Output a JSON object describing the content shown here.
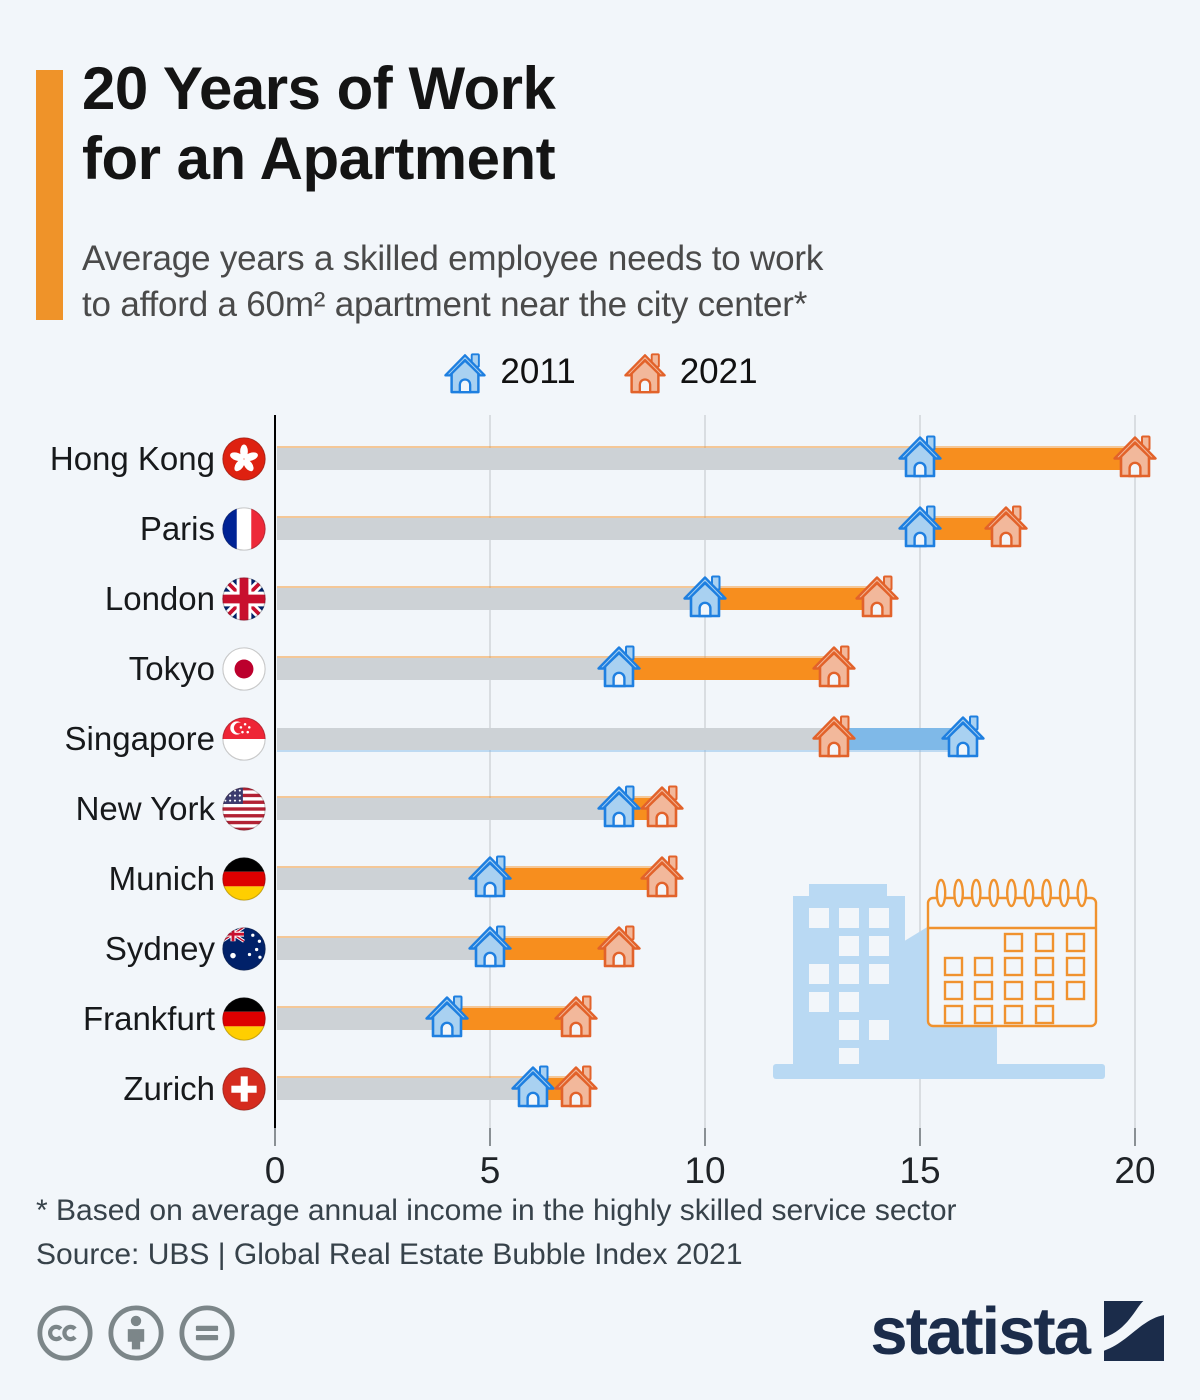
{
  "page": {
    "background_color": "#F2F6FA"
  },
  "header": {
    "accent_color": "#EF9329",
    "title_line1": "20 Years of Work",
    "title_line2": "for an Apartment",
    "subtitle_line1": "Average years a skilled employee needs to work",
    "subtitle_line2": "to afford a 60m² apartment near the city center*"
  },
  "chart_data": {
    "type": "dumbbell",
    "title": "20 Years of Work for an Apartment",
    "unit": "years of work",
    "categories": [
      "Hong Kong",
      "Paris",
      "London",
      "Tokyo",
      "Singapore",
      "New York",
      "Munich",
      "Sydney",
      "Frankfurt",
      "Zurich"
    ],
    "flags": [
      "hong-kong",
      "france",
      "uk",
      "japan",
      "singapore",
      "usa",
      "germany",
      "australia",
      "germany",
      "switzerland"
    ],
    "series": [
      {
        "name": "2011",
        "values": [
          15,
          15,
          10,
          8,
          16,
          8,
          5,
          5,
          4,
          6
        ]
      },
      {
        "name": "2021",
        "values": [
          20,
          17,
          14,
          13,
          13,
          9,
          9,
          8,
          7,
          7
        ]
      }
    ],
    "xlim": [
      0,
      20
    ],
    "xticks": [
      0,
      5,
      10,
      15,
      20
    ],
    "legend_position": "top",
    "grid": "vertical",
    "colors": {
      "increase_segment": "#F78E1E",
      "decrease_segment": "#7FB9E8",
      "track": "#CDD2D6",
      "house_2011_stroke": "#1E7FE0",
      "house_2011_fill": "#A9D1F1",
      "house_2021_stroke": "#E2622A",
      "house_2021_fill": "#F2B89B",
      "house_door": "#F2F6FA",
      "axis_line": "#000000",
      "gridline": "#D9DDE1",
      "tick": "#8A9094",
      "tick_label": "#1F2327"
    }
  },
  "footer": {
    "footnote": "* Based on average annual income in the highly skilled service sector",
    "source": "Source: UBS | Global Real Estate Bubble Index 2021"
  },
  "branding": {
    "logo_text": "statista",
    "logo_color": "#1B2C4A",
    "license_icons": [
      "cc-icon",
      "attribution-icon",
      "no-derivatives-icon"
    ]
  }
}
